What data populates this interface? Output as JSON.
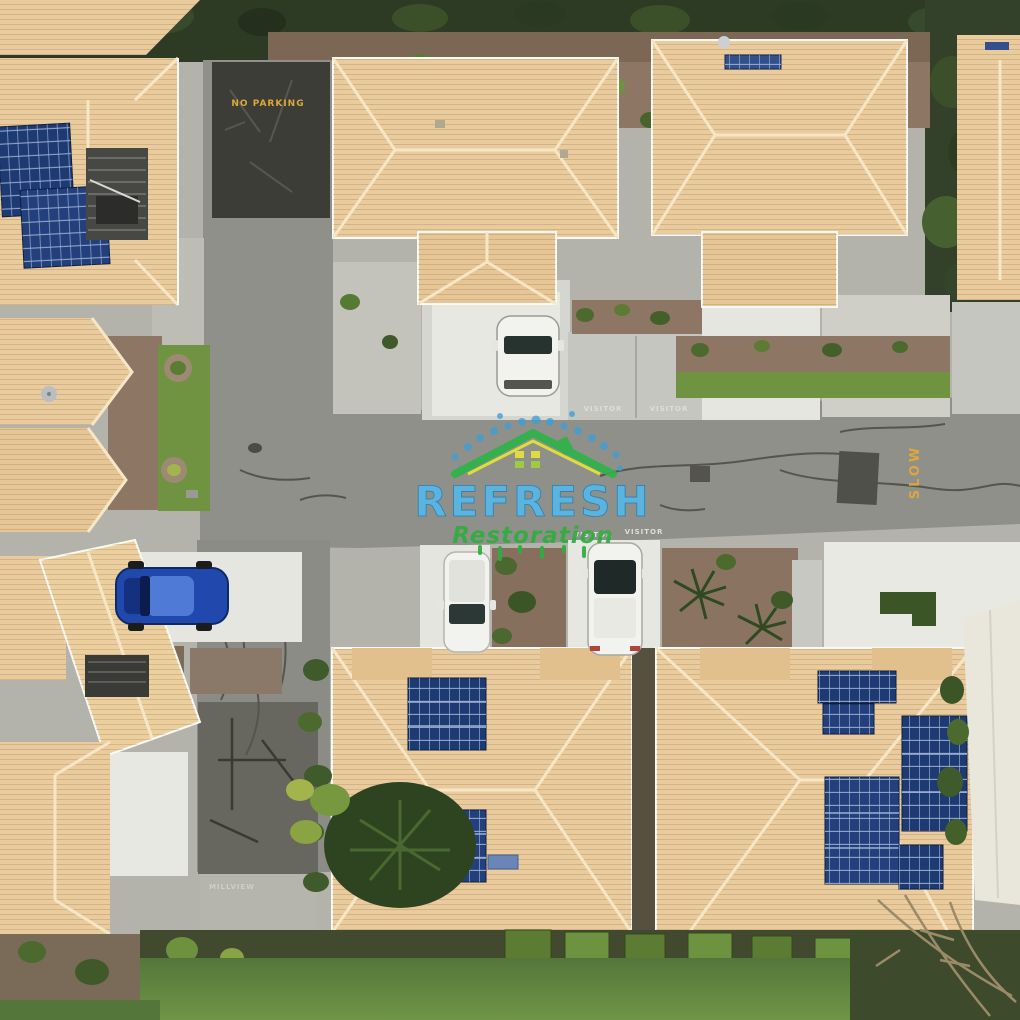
{
  "photo": {
    "description": "Aerial drone view of a residential townhouse complex: tan tiled roofs with rooftop solar arrays, grey internal roads, white concrete driveways, parked cars, lawns and gardens",
    "watermark": {
      "title": "REFRESH",
      "subtitle": "Restoration",
      "colors": {
        "title_blue": "#57b7e8",
        "subtitle_green": "#2fae3f",
        "roof_green": "#2fb34a",
        "trim_yellow": "#e8e23c",
        "dots_blue": "#3f9fd8"
      }
    },
    "road_markings": {
      "no_parking": "NO PARKING",
      "slow": "SLOW",
      "visitor_top_left": "VISITOR",
      "visitor_top_right": "VISITOR",
      "visitor_bottom_left": "VISITOR",
      "visitor_bottom_right": "VISITOR",
      "driveway_label": "MILLVIEW",
      "marking_yellow": "#dca73c",
      "stencil_white": "#dedED8"
    },
    "scene_colors": {
      "asphalt": "#90908a",
      "asphalt_dark": "#3c3d37",
      "concrete": "#c6c6c0",
      "driveway_white": "#e8e8e3",
      "roof_tile": "#e9cb9d",
      "roof_ridge": "#f6e6c6",
      "solar_panel": "#1e3a72",
      "grass": "#6f9340",
      "shrub": "#4c6a2e",
      "mulch": "#8d7663",
      "tree_canopy": "#2d3b25",
      "blue_car": "#2149ad",
      "white_car": "#f2f2ee"
    }
  }
}
